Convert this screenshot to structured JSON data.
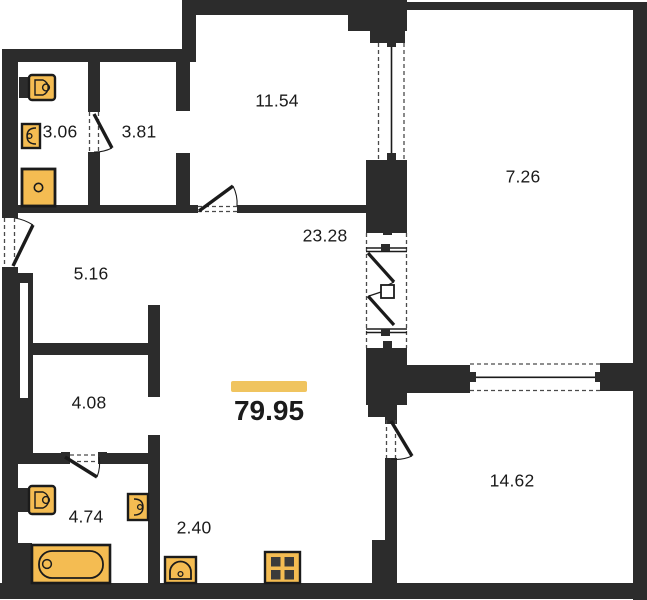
{
  "plan": {
    "total_area": "79.95",
    "rooms": [
      {
        "name": "bathroom-top",
        "area": "3.06"
      },
      {
        "name": "hall-top",
        "area": "3.81"
      },
      {
        "name": "room-top",
        "area": "11.54"
      },
      {
        "name": "loggia-right",
        "area": "7.26"
      },
      {
        "name": "living-kitchen",
        "area": "23.28"
      },
      {
        "name": "hallway",
        "area": "5.16"
      },
      {
        "name": "corridor",
        "area": "4.08"
      },
      {
        "name": "bedroom",
        "area": "14.62"
      },
      {
        "name": "bathroom-bottom",
        "area": "4.74"
      },
      {
        "name": "wc-hall",
        "area": "2.40"
      }
    ],
    "icons": [
      "toilet-icon",
      "sink-icon",
      "shower-tray-icon",
      "bathtub-icon",
      "stove-icon",
      "door-swing",
      "window",
      "folding-door",
      "wardrobe-niche"
    ],
    "colors": {
      "wall": "#2c2c2c",
      "fixture": "#f4bc52",
      "fixture_dark": "#3b3b3b",
      "highlight": "#f0c45f",
      "background": "#ffffff",
      "text": "#1b1b1b",
      "dash": "#4a4a4a"
    }
  }
}
